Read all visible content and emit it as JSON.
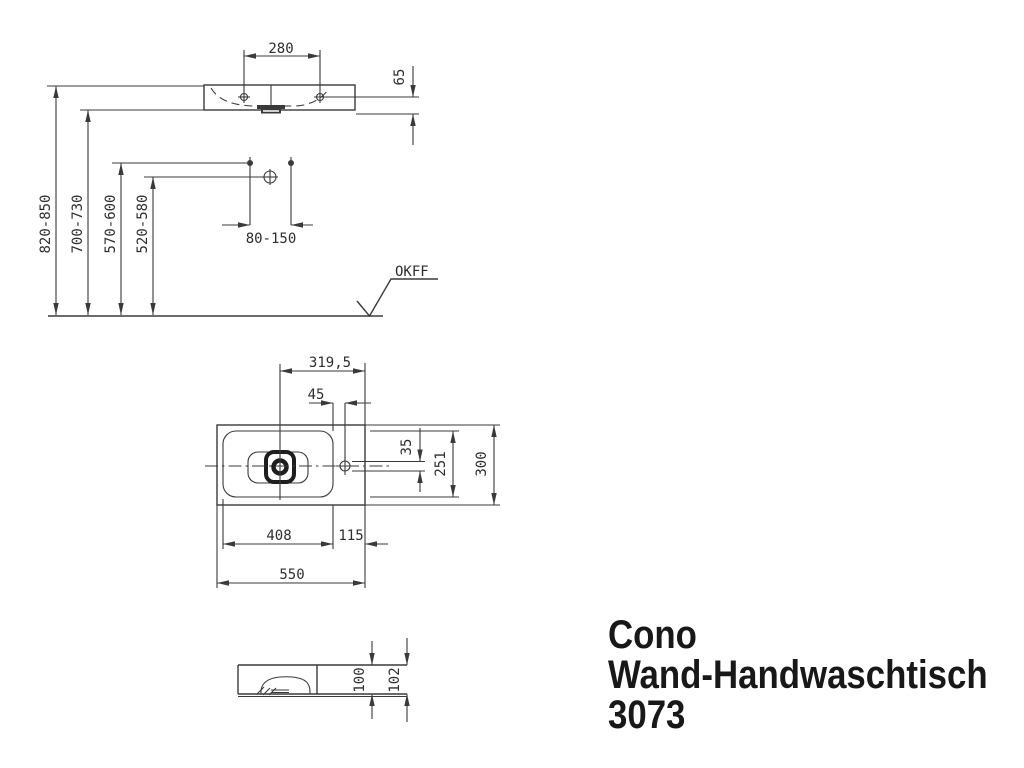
{
  "colors": {
    "ink": "#3a3a3a",
    "text": "#2d2d2d",
    "title": "#181818",
    "background": "#ffffff"
  },
  "title_block": {
    "line1": "Cono",
    "line2": "Wand-Handwaschtisch",
    "line3": "3073"
  },
  "front_view": {
    "tap_hole_spacing": "280",
    "rim_height": "65",
    "height_top_edge": "820-850",
    "height_bottom_edge": "700-730",
    "height_fixing_bolts": "570-600",
    "height_water_connection": "520-580",
    "fixing_bolt_spread": "80-150",
    "floor_reference": "OKFF"
  },
  "plan_view": {
    "drain_to_right_edge": "319,5",
    "tap_hole_inset": "45",
    "tap_hole_offset": "35",
    "inner_depth": "251",
    "total_depth": "300",
    "inner_width": "408",
    "deck_width": "115",
    "total_width": "550"
  },
  "section_view": {
    "body_height": "100",
    "total_height": "102"
  }
}
